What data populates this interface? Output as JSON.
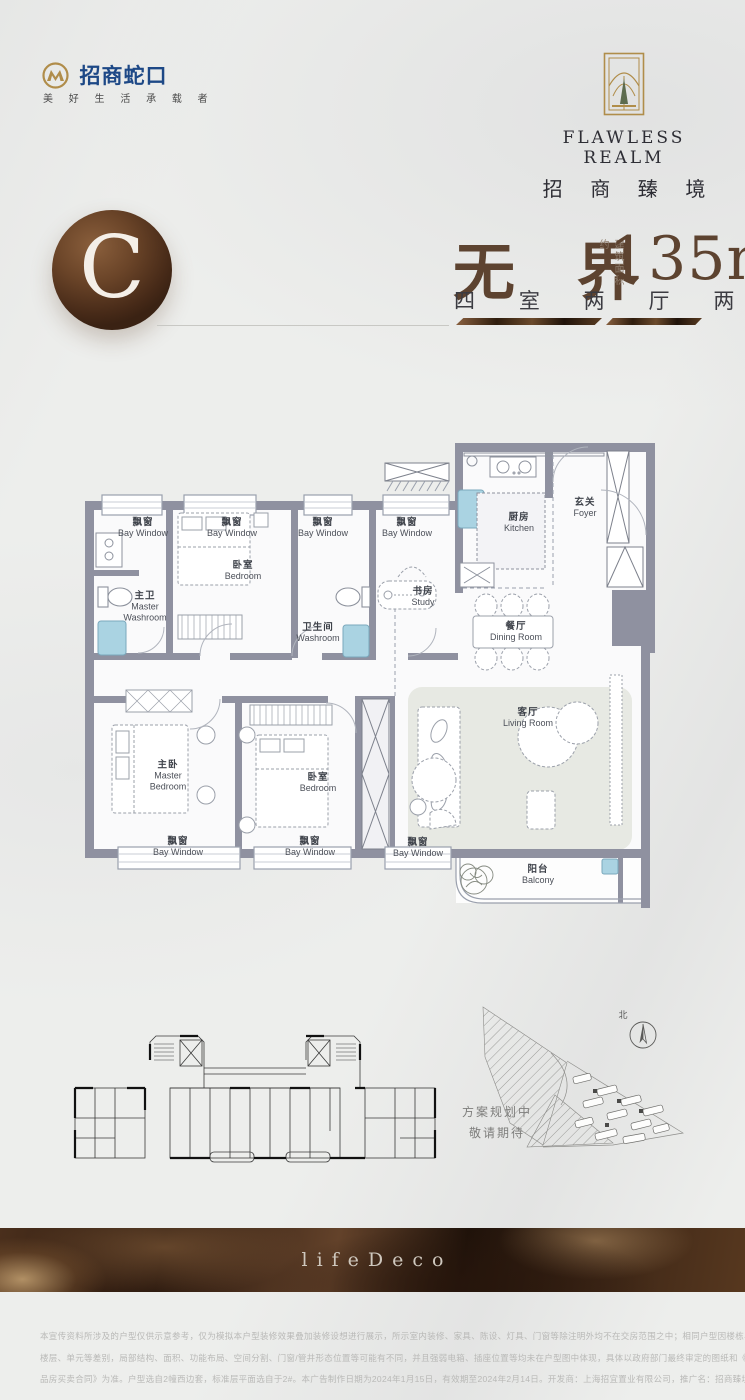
{
  "brand": {
    "logo_text": "招商蛇口",
    "tagline": "美 好 生 活 承 载 者",
    "project_name_en": "FLAWLESS REALM",
    "project_name_zh": "招 商 臻 境"
  },
  "unit": {
    "letter": "C",
    "title": "无 界",
    "area_note": "建筑面积约",
    "area_value": "135m",
    "area_sup": "2",
    "layout": "四 室 两 厅 两 卫"
  },
  "plan": {
    "rooms": [
      {
        "zh": "飘窗",
        "en": "Bay Window"
      },
      {
        "zh": "飘窗",
        "en": "Bay Window"
      },
      {
        "zh": "卧室",
        "en": "Bedroom"
      },
      {
        "zh": "飘窗",
        "en": "Bay Window"
      },
      {
        "zh": "飘窗",
        "en": "Bay Window"
      },
      {
        "zh": "厨房",
        "en": "Kitchen"
      },
      {
        "zh": "玄关",
        "en": "Foyer"
      },
      {
        "zh": "主卫",
        "en": "Master Washroom"
      },
      {
        "zh": "书房",
        "en": "Study"
      },
      {
        "zh": "卫生间",
        "en": "Washroom"
      },
      {
        "zh": "餐厅",
        "en": "Dining Room"
      },
      {
        "zh": "主卧",
        "en": "Master Bedroom"
      },
      {
        "zh": "卧室",
        "en": "Bedroom"
      },
      {
        "zh": "客厅",
        "en": "Living Room"
      },
      {
        "zh": "飘窗",
        "en": "Bay Window"
      },
      {
        "zh": "飘窗",
        "en": "Bay Window"
      },
      {
        "zh": "飘窗",
        "en": "Bay Window"
      },
      {
        "zh": "阳台",
        "en": "Balcony"
      }
    ]
  },
  "siteplan": {
    "north_label": "北",
    "note_line1": "方案规划中",
    "note_line2": "敬请期待"
  },
  "footer": {
    "band_text": "lifeDeco",
    "disclaimer_lines": [
      "本宣传资料所涉及的户型仅供示意参考，仅为模拟本户型装修效果叠加装修设想进行展示，所示室内装修、家具、陈设、灯具、门窗等除注明外均不在交房范围之中；相同户型因楼栋、",
      "楼层、单元等差别，局部结构、面积、功能布局、空间分割、门窗/管井形态位置等可能有不同，并且强弱电箱、插座位置等均未在户型图中体现，具体以政府部门最终审定的图纸和《商",
      "品房买卖合同》为准。户型选自2幢西边套，标准层平面选自于2#。本广告制作日期为2024年1月15日，有效期至2024年2月14日。开发商：上海招宜置业有限公司，推广名：招商臻境。"
    ]
  },
  "colors": {
    "brand_blue": "#1d4886",
    "brand_gold": "#b08d4a",
    "title_brown": "#5d4330",
    "wall_gray": "#8f91a0",
    "fixture_blue": "#aad3e2",
    "band_brown": "#2a180e"
  }
}
